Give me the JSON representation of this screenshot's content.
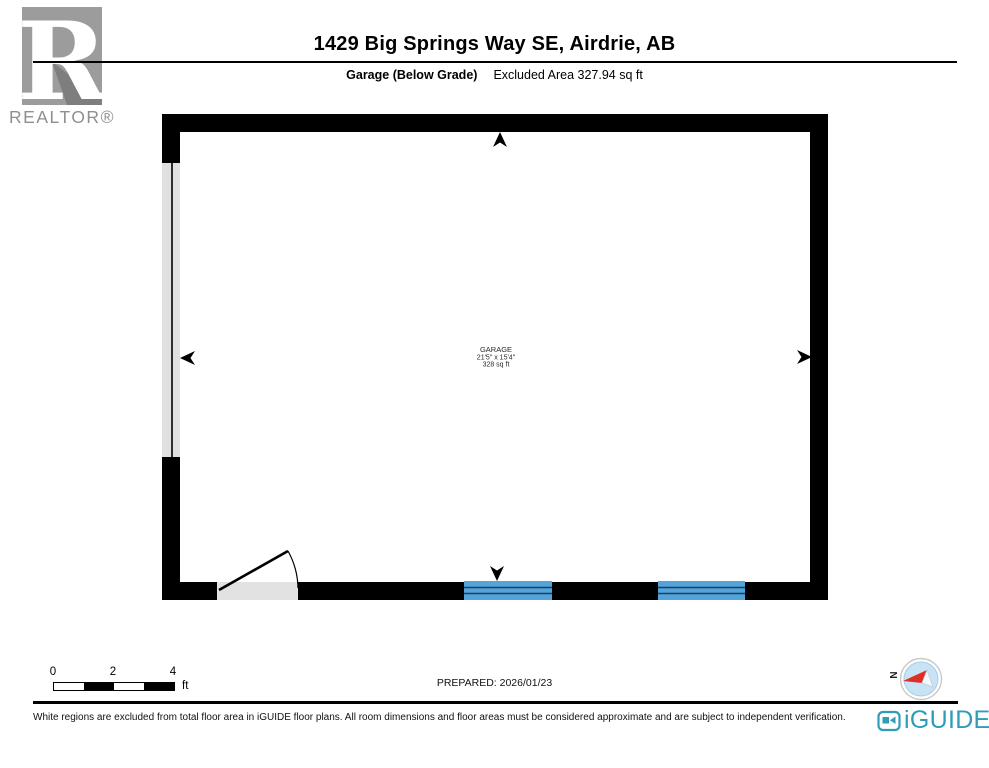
{
  "header": {
    "title": "1429 Big Springs Way SE, Airdrie, AB",
    "floor_label": "Garage (Below Grade)",
    "excluded_area": "Excluded Area 327.94 sq ft"
  },
  "branding": {
    "realtor_logo_letter": "R",
    "realtor_text": "REALTOR®",
    "iguide_text": "iGUIDE"
  },
  "floorplan": {
    "room": {
      "name": "GARAGE",
      "dimensions": "21'5\" x 15'4\"",
      "area": "328 sq ft"
    },
    "features": [
      "garage-door-left-wall",
      "swing-door-bottom-left",
      "window-bottom-1",
      "window-bottom-2"
    ],
    "markers": [
      "camera-arrow-up",
      "camera-arrow-left",
      "camera-arrow-right",
      "camera-arrow-down"
    ]
  },
  "scale_bar": {
    "ticks": [
      "0",
      "2",
      "4"
    ],
    "unit": "ft"
  },
  "footer": {
    "prepared": "PREPARED: 2026/01/23",
    "compass_label": "N",
    "disclaimer": "White regions are excluded from total floor area in iGUIDE floor plans. All room dimensions and floor areas must be considered approximate and are subject to independent verification."
  },
  "colors": {
    "wall": "#000000",
    "window_blue": "#54a3d9",
    "window_line": "#16425f",
    "opening_gray": "#e0e0e0",
    "realtor_gray": "#9c9c9c",
    "iguide_teal": "#2f9cba",
    "compass_red": "#e02d26",
    "compass_fill": "#c9e3f4"
  }
}
